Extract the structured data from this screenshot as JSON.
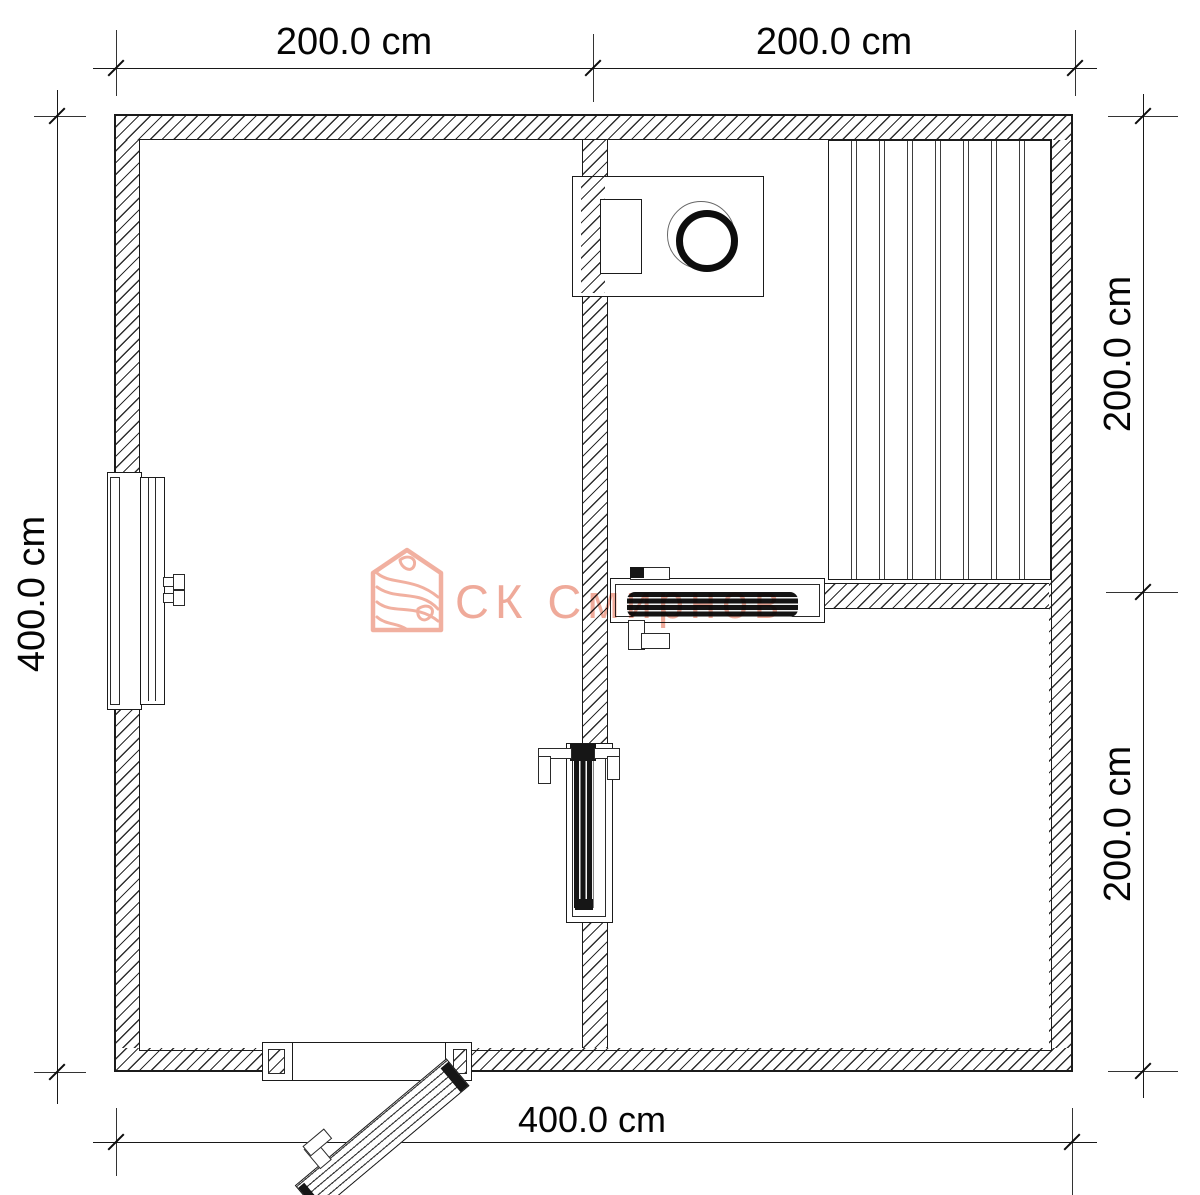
{
  "canvas": {
    "width": 1200,
    "height": 1195,
    "background": "#ffffff"
  },
  "colors": {
    "line": "#1b1b1b",
    "hatch_line": "#2e2e2e",
    "dimension_text": "#050505",
    "watermark": "#ec9b88"
  },
  "dimensions": {
    "top": [
      {
        "label": "200.0 cm"
      },
      {
        "label": "200.0 cm"
      }
    ],
    "right": [
      {
        "label": "200.0 cm"
      },
      {
        "label": "200.0 cm"
      }
    ],
    "left": [
      {
        "label": "400.0 cm"
      }
    ],
    "bottom": [
      {
        "label": "400.0 cm"
      }
    ]
  },
  "watermark": {
    "text": "СК Смирнов"
  }
}
